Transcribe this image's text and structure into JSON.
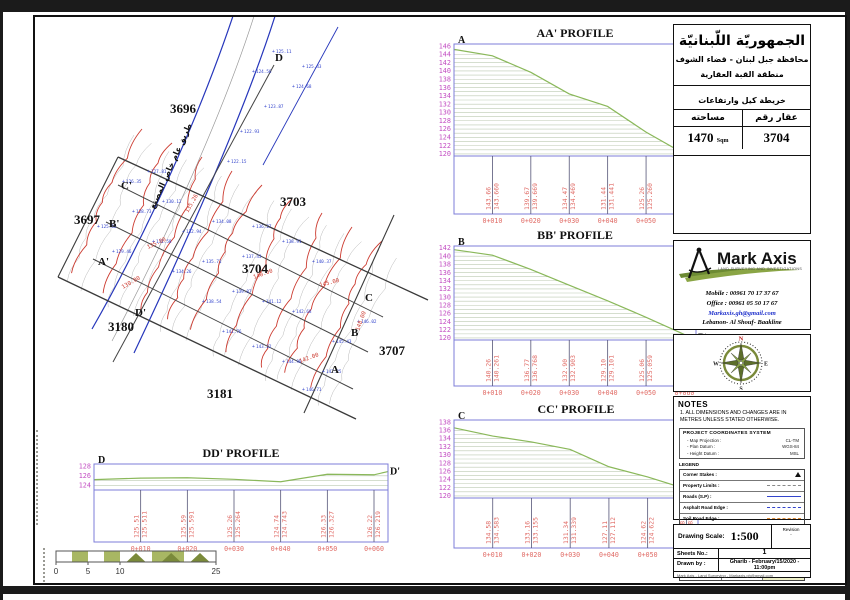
{
  "header": {
    "country_title": "الجمهوريّة اللّبنانيّة",
    "governorate_line": "محافظة جبل لبنان - قضاء الشوف",
    "district_line": "منطقة القبة العقارية",
    "map_type": "خريطة كيل وارتفاعات",
    "area_label": "مساحته",
    "plot_label": "عقار رقم",
    "area_value": "1470",
    "area_unit": "Sqm",
    "plot_value": "3704"
  },
  "company": {
    "name": "Mark Axis",
    "tagline": "LAND SURVEYING AND INVESTIGATIONS",
    "mobile": "Mobile : 00961 70 17 37 67",
    "office": "Office : 00961 05 50 17 67",
    "email": "Markaxis.gh@gmail.com",
    "address": "Lebanon- Al Shouf- Baakline"
  },
  "compass": {
    "n": "N",
    "s": "S",
    "e": "E",
    "w": "W"
  },
  "notes": {
    "heading": "NOTES",
    "note1": "1.  ALL DIMENSIONS AND CHANGES ARE IN METRES UNLESS STATED OTHERWISE.",
    "coord_title": "PROJECT COORDINATES SYSTEM",
    "coord_rows": [
      {
        "label": "- Map Projection :",
        "value": "CL-TM"
      },
      {
        "label": "- Plan Datum :",
        "value": "WGS-84"
      },
      {
        "label": "- Height Datum :",
        "value": "MSL"
      }
    ],
    "legend_title": "LEGEND",
    "legend_rows": [
      {
        "label": "Corner Stakes :",
        "sym": "tri"
      },
      {
        "label": "Property Limits :",
        "sym": "dash-gray"
      },
      {
        "label": "Roads (S.P) :",
        "sym": "line-blue"
      },
      {
        "label": "Asphalt Road Edge :",
        "sym": "dash-blue"
      },
      {
        "label": "Soil Road Edge :",
        "sym": "dash-orange"
      },
      {
        "label": "Building :",
        "sym": "line-gray"
      },
      {
        "label": "Walls :",
        "sym": "line-gray"
      },
      {
        "label": "Elevs. Limits :",
        "sym": "line-red"
      },
      {
        "label": "Sewer :",
        "sym": "line-gray"
      }
    ],
    "legend_bottom": [
      {
        "label": "Trees :",
        "sym": "circ"
      },
      {
        "label": "Power",
        "sym": "line-gray"
      },
      {
        "label": "Bor. Poles",
        "sym": "none"
      }
    ]
  },
  "titleblock": {
    "scale_label": "Drawing Scale:",
    "scale_value": "1:500",
    "revision_label": "Revision",
    "revision_value": "-",
    "sheets_label": "Sheets No.:",
    "sheets_value": "1",
    "drawn_label": "Drawn by :",
    "drawn_value": "Gharib  -  February/15/2020  -  11:00pm",
    "footer_line": "Mark Axis - Land Surveying - Markaxis.gh@gmail.com"
  },
  "scalebar": {
    "ticks": [
      "0",
      "5",
      "10",
      "25"
    ]
  },
  "map": {
    "road_label": "طريق عام خاص المصنع",
    "plot_labels": [
      {
        "t": "3696",
        "x": 132,
        "y": 96
      },
      {
        "t": "3703",
        "x": 242,
        "y": 189
      },
      {
        "t": "3697",
        "x": 36,
        "y": 207
      },
      {
        "t": "3704",
        "x": 204,
        "y": 256
      },
      {
        "t": "3180",
        "x": 70,
        "y": 314
      },
      {
        "t": "3181",
        "x": 169,
        "y": 381
      },
      {
        "t": "3707",
        "x": 341,
        "y": 338
      }
    ],
    "section_labels": [
      {
        "t": "D",
        "x": 237,
        "y": 44
      },
      {
        "t": "C'",
        "x": 83,
        "y": 172
      },
      {
        "t": "B'",
        "x": 71,
        "y": 210
      },
      {
        "t": "A'",
        "x": 60,
        "y": 248
      },
      {
        "t": "D'",
        "x": 97,
        "y": 299
      },
      {
        "t": "C",
        "x": 327,
        "y": 284
      },
      {
        "t": "B",
        "x": 313,
        "y": 319
      },
      {
        "t": "A",
        "x": 293,
        "y": 356
      }
    ],
    "contour_labels": [
      {
        "t": "135.26",
        "x": 150,
        "y": 196,
        "r": -60
      },
      {
        "t": "135.00",
        "x": 110,
        "y": 232,
        "r": -25
      },
      {
        "t": "130.00",
        "x": 85,
        "y": 272,
        "r": -30
      },
      {
        "t": "140.00",
        "x": 216,
        "y": 262,
        "r": -20
      },
      {
        "t": "145.00",
        "x": 282,
        "y": 270,
        "r": -15
      },
      {
        "t": "142.00",
        "x": 262,
        "y": 346,
        "r": -20
      },
      {
        "t": "148.00",
        "x": 321,
        "y": 314,
        "r": -70
      }
    ],
    "spot_points": [
      {
        "x": 264,
        "y": 374,
        "v": "146.71"
      },
      {
        "x": 284,
        "y": 356,
        "v": "147.25"
      },
      {
        "x": 244,
        "y": 346,
        "v": "144.98"
      },
      {
        "x": 214,
        "y": 331,
        "v": "143.22"
      },
      {
        "x": 184,
        "y": 316,
        "v": "141.76"
      },
      {
        "x": 294,
        "y": 326,
        "v": "145.43"
      },
      {
        "x": 319,
        "y": 306,
        "v": "146.02"
      },
      {
        "x": 164,
        "y": 286,
        "v": "138.54"
      },
      {
        "x": 194,
        "y": 276,
        "v": "139.87"
      },
      {
        "x": 224,
        "y": 286,
        "v": "141.12"
      },
      {
        "x": 254,
        "y": 296,
        "v": "142.68"
      },
      {
        "x": 134,
        "y": 256,
        "v": "134.26"
      },
      {
        "x": 164,
        "y": 246,
        "v": "135.71"
      },
      {
        "x": 204,
        "y": 241,
        "v": "137.43"
      },
      {
        "x": 114,
        "y": 226,
        "v": "131.58"
      },
      {
        "x": 144,
        "y": 216,
        "v": "132.94"
      },
      {
        "x": 174,
        "y": 206,
        "v": "134.08"
      },
      {
        "x": 94,
        "y": 196,
        "v": "128.73"
      },
      {
        "x": 124,
        "y": 186,
        "v": "130.12"
      },
      {
        "x": 84,
        "y": 166,
        "v": "126.35"
      },
      {
        "x": 109,
        "y": 156,
        "v": "127.81"
      },
      {
        "x": 74,
        "y": 236,
        "v": "129.46"
      },
      {
        "x": 59,
        "y": 211,
        "v": "125.62"
      },
      {
        "x": 214,
        "y": 211,
        "v": "136.27"
      },
      {
        "x": 244,
        "y": 226,
        "v": "138.91"
      },
      {
        "x": 274,
        "y": 246,
        "v": "140.37"
      },
      {
        "x": 214,
        "y": 56,
        "v": "124.56"
      },
      {
        "x": 226,
        "y": 91,
        "v": "123.87"
      },
      {
        "x": 202,
        "y": 116,
        "v": "122.93"
      },
      {
        "x": 189,
        "y": 146,
        "v": "122.15"
      },
      {
        "x": 234,
        "y": 36,
        "v": "125.11"
      },
      {
        "x": 264,
        "y": 51,
        "v": "125.43"
      },
      {
        "x": 254,
        "y": 71,
        "v": "124.68"
      }
    ]
  },
  "chart_data": [
    {
      "type": "area",
      "id": "AA",
      "title": "AA' PROFILE",
      "start_label": "A",
      "end_label": "A'",
      "ylim": [
        119.5,
        146.5
      ],
      "yticks": [
        146,
        144,
        142,
        140,
        138,
        136,
        134,
        132,
        130,
        128,
        126,
        124,
        122,
        120
      ],
      "stations": [
        "0+010",
        "0+020",
        "0+030",
        "0+040",
        "0+050",
        "0+060"
      ],
      "station_m": [
        10,
        20,
        30,
        40,
        50,
        60
      ],
      "elevations": [
        143.66,
        139.67,
        134.47,
        131.44,
        125.26,
        120.01
      ],
      "elev_labels": [
        [
          "143.66",
          "143.660"
        ],
        [
          "139.67",
          "139.669"
        ],
        [
          "134.47",
          "134.469"
        ],
        [
          "131.44",
          "131.441"
        ],
        [
          "125.26",
          "125.260"
        ],
        [
          "120.01",
          "120.011"
        ]
      ],
      "start_elev": 145.2,
      "end_elev": 120.0
    },
    {
      "type": "area",
      "id": "BB",
      "title": "BB' PROFILE",
      "start_label": "B",
      "end_label": "B'",
      "ylim": [
        119.5,
        142.5
      ],
      "yticks": [
        142,
        140,
        138,
        136,
        134,
        132,
        130,
        128,
        126,
        124,
        122,
        120
      ],
      "stations": [
        "0+010",
        "0+020",
        "0+030",
        "0+040",
        "0+050",
        "0+060"
      ],
      "station_m": [
        10,
        20,
        30,
        40,
        50,
        60
      ],
      "elevations": [
        140.26,
        136.77,
        132.9,
        129.1,
        125.06,
        120.84
      ],
      "elev_labels": [
        [
          "140.26",
          "140.261"
        ],
        [
          "136.77",
          "136.768"
        ],
        [
          "132.90",
          "132.903"
        ],
        [
          "129.10",
          "129.101"
        ],
        [
          "125.06",
          "125.059"
        ],
        [
          "120.84",
          "120.836"
        ]
      ],
      "start_elev": 141.6,
      "end_elev": 120.1
    },
    {
      "type": "area",
      "id": "CC",
      "title": "CC' PROFILE",
      "start_label": "C",
      "end_label": "C'",
      "ylim": [
        119.5,
        138.5
      ],
      "yticks": [
        138,
        136,
        134,
        132,
        130,
        128,
        126,
        124,
        122,
        120
      ],
      "stations": [
        "0+010",
        "0+020",
        "0+030",
        "0+040",
        "0+050",
        "0+060"
      ],
      "station_m": [
        10,
        20,
        30,
        40,
        50,
        60
      ],
      "elevations": [
        134.58,
        133.16,
        131.34,
        127.11,
        124.62,
        121.68
      ],
      "elev_labels": [
        [
          "134.58",
          "134.583"
        ],
        [
          "133.16",
          "133.155"
        ],
        [
          "131.34",
          "131.339"
        ],
        [
          "127.11",
          "127.112"
        ],
        [
          "124.62",
          "124.622"
        ],
        [
          "121.68",
          "121.683"
        ]
      ],
      "start_elev": 136.6,
      "end_elev": 120.3
    },
    {
      "type": "area",
      "id": "DD",
      "title": "DD' PROFILE",
      "start_label": "D",
      "end_label": "D'",
      "ylim": [
        123.0,
        128.5
      ],
      "yticks": [
        128,
        126,
        124
      ],
      "stations": [
        "0+010",
        "0+020",
        "0+030",
        "0+040",
        "0+050",
        "0+060"
      ],
      "station_m": [
        10,
        20,
        30,
        40,
        50,
        60
      ],
      "elevations": [
        125.51,
        125.59,
        125.26,
        124.74,
        126.33,
        126.22
      ],
      "elev_labels": [
        [
          "125.51",
          "125.511"
        ],
        [
          "125.59",
          "125.591"
        ],
        [
          "125.26",
          "125.264"
        ],
        [
          "124.74",
          "124.743"
        ],
        [
          "126.33",
          "126.327"
        ],
        [
          "126.22",
          "126.219"
        ]
      ],
      "start_elev": 125.2,
      "end_elev": 126.9
    }
  ]
}
